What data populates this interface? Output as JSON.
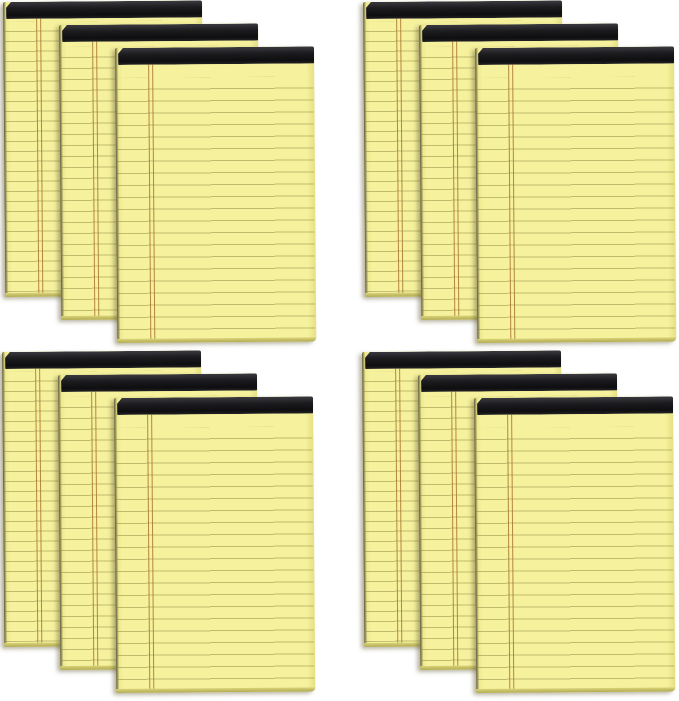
{
  "image": {
    "type": "product-photo",
    "subject": "12-pack of yellow ruled legal note pads with black top bindings, shown as four fanned stacks of three pads",
    "background_color": "#ffffff",
    "total_pads": 12,
    "pads_per_stack": 3,
    "stacks": [
      {
        "position": "top-left",
        "pad_count": 3,
        "layers": [
          "back",
          "middle",
          "front"
        ]
      },
      {
        "position": "top-right",
        "pad_count": 3,
        "layers": [
          "back",
          "middle",
          "front"
        ]
      },
      {
        "position": "bottom-left",
        "pad_count": 3,
        "layers": [
          "back",
          "middle",
          "front"
        ]
      },
      {
        "position": "bottom-right",
        "pad_count": 3,
        "layers": [
          "back",
          "middle",
          "front"
        ]
      }
    ],
    "pad_features": {
      "binding": "black tape strip across the top edge",
      "ruling": "horizontal olive rule lines across full width",
      "margin": "double vertical brown margin line near the left edge",
      "paper": "canary yellow sheets with darker stacked-page bottom edge"
    },
    "colors": {
      "paper": "#f5f19d",
      "paper_shadowed": "#e9e385",
      "binding_black": "#1b1b1e",
      "binding_highlight": "#3a3a40",
      "rule_line": "#8c853c",
      "margin_line": "#a9752e",
      "bottom_edge": "#d9d378",
      "right_edge": "#e6e084",
      "spine_line": "#5a563e",
      "background": "#ffffff"
    }
  }
}
